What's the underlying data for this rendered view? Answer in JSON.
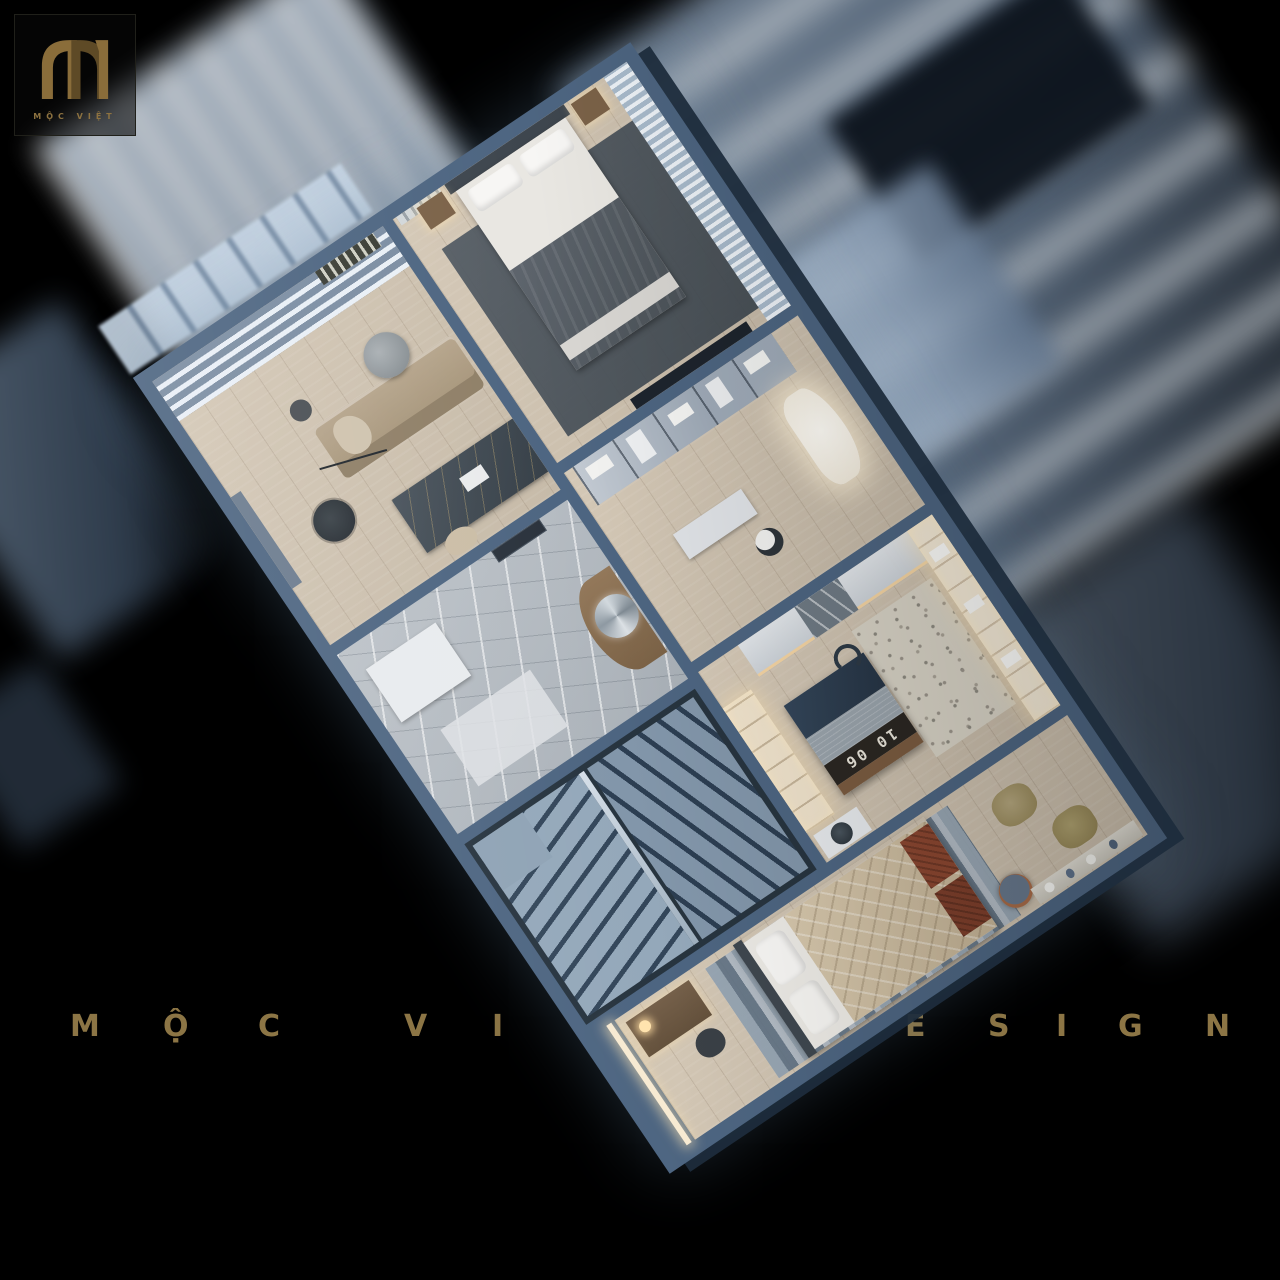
{
  "brand": {
    "logo_monogram": "M",
    "logo_text": "MỘC VIỆT"
  },
  "watermark": {
    "full_text": "MỘC VIỆT DESIGN",
    "letters": [
      "M",
      "Ộ",
      "C",
      "V",
      "I",
      "Ệ",
      "T",
      "D",
      "E",
      "S",
      "I",
      "G",
      "N"
    ]
  },
  "plan": {
    "island_clock": "10 06"
  },
  "colors": {
    "background": "#000000",
    "wall_steel_blue": "#4d6581",
    "gold_brand": "#8c7545",
    "wood_floor": "#ccc1af",
    "marble_floor": "#b6bcc2",
    "island_navy": "#2e3e50",
    "warm_shelf_light": "#f5e9d2"
  }
}
